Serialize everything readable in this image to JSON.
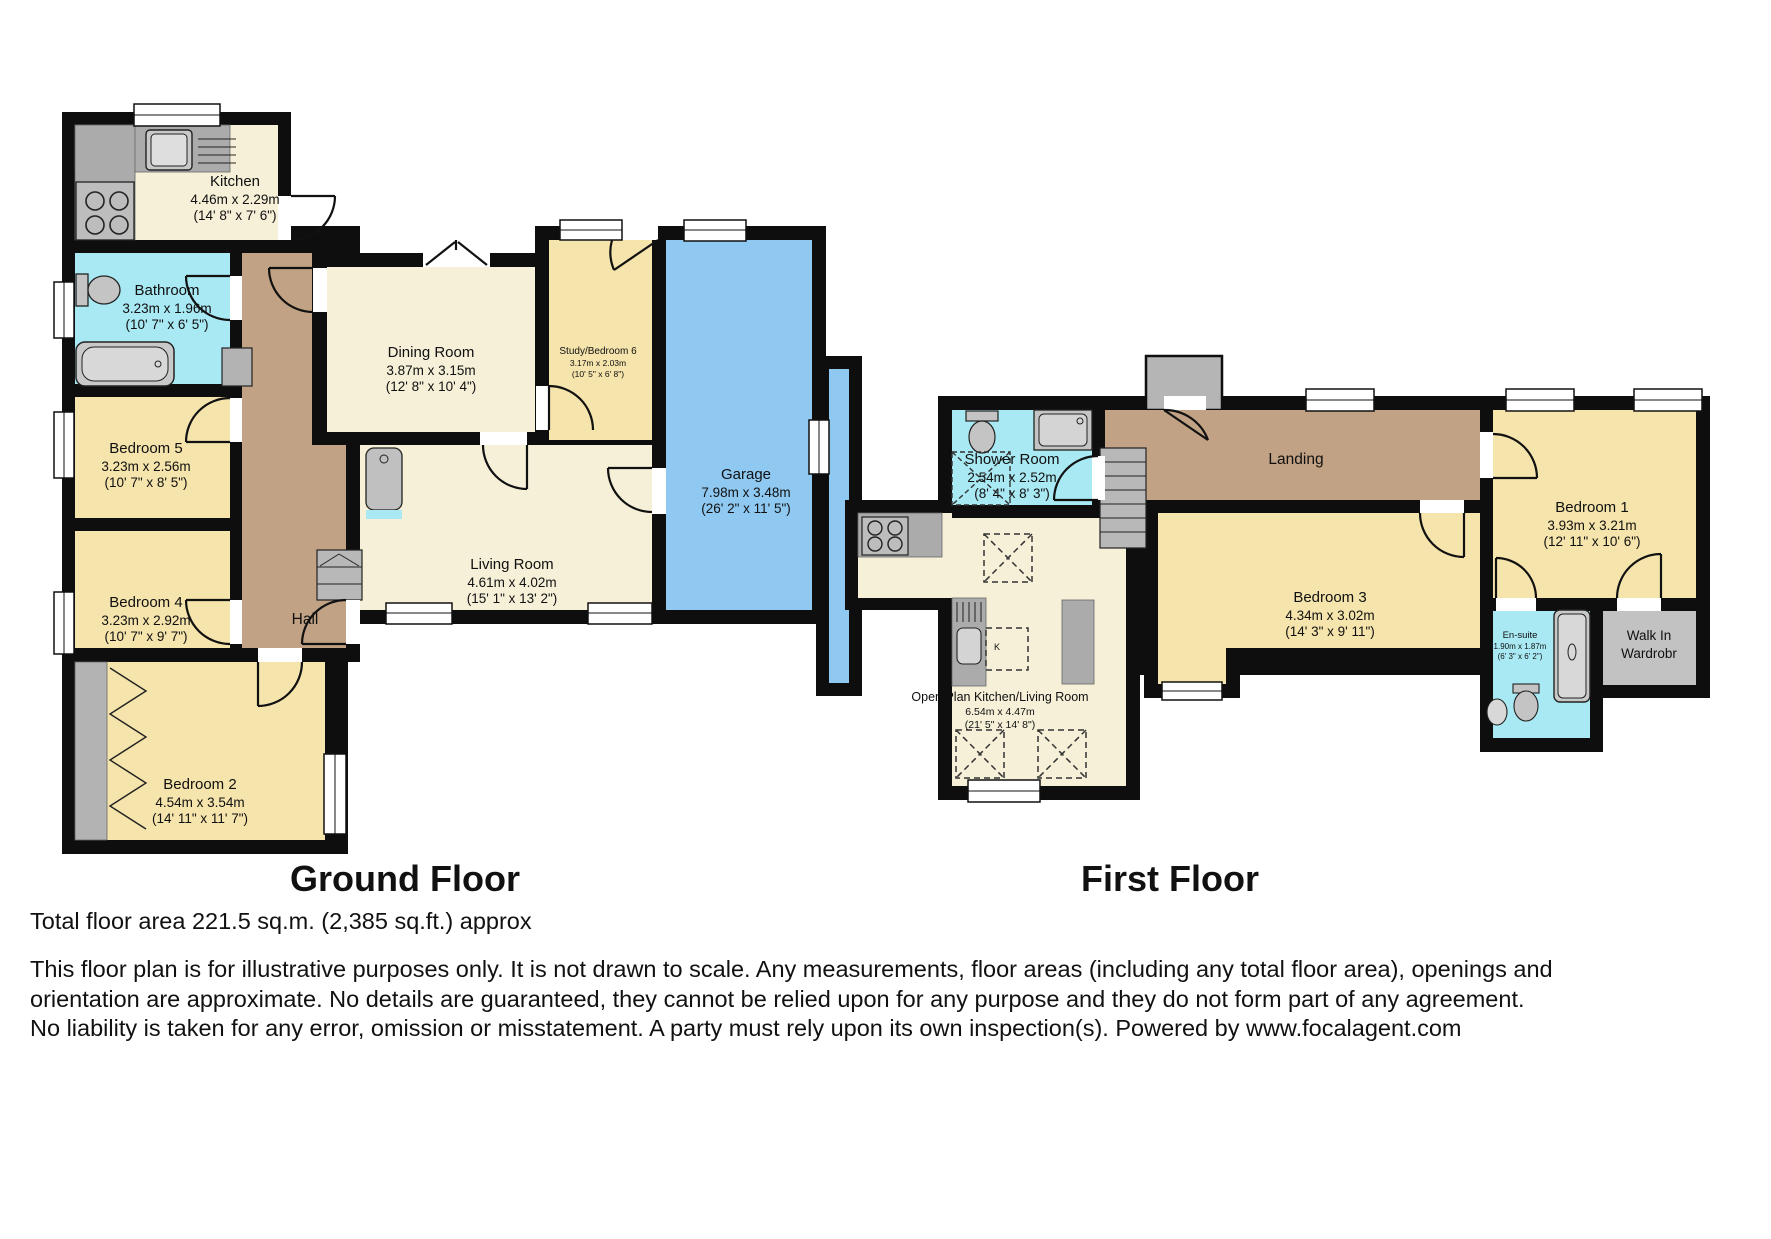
{
  "ground_floor": {
    "title": "Ground Floor",
    "rooms": {
      "kitchen": {
        "name": "Kitchen",
        "metric": "4.46m x 2.29m",
        "imperial": "(14' 8\" x 7' 6\")"
      },
      "bathroom": {
        "name": "Bathroom",
        "metric": "3.23m x 1.96m",
        "imperial": "(10' 7\" x 6' 5\")"
      },
      "dining": {
        "name": "Dining Room",
        "metric": "3.87m x 3.15m",
        "imperial": "(12' 8\" x 10' 4\")"
      },
      "study": {
        "name": "Study/Bedroom 6",
        "metric": "3.17m x 2.03m",
        "imperial": "(10' 5\" x 6' 8\")"
      },
      "garage": {
        "name": "Garage",
        "metric": "7.98m x 3.48m",
        "imperial": "(26' 2\" x 11' 5\")"
      },
      "bedroom5": {
        "name": "Bedroom 5",
        "metric": "3.23m x 2.56m",
        "imperial": "(10' 7\" x 8' 5\")"
      },
      "bedroom4": {
        "name": "Bedroom 4",
        "metric": "3.23m x 2.92m",
        "imperial": "(10' 7\" x 9' 7\")"
      },
      "living": {
        "name": "Living Room",
        "metric": "4.61m x 4.02m",
        "imperial": "(15' 1\" x 13' 2\")"
      },
      "hall": {
        "name": "Hall"
      },
      "bedroom2": {
        "name": "Bedroom 2",
        "metric": "4.54m x 3.54m",
        "imperial": "(14' 11\" x 11' 7\")"
      }
    }
  },
  "first_floor": {
    "title": "First Floor",
    "rooms": {
      "shower": {
        "name": "Shower Room",
        "metric": "2.54m x 2.52m",
        "imperial": "(8' 4\" x 8' 3\")"
      },
      "landing": {
        "name": "Landing"
      },
      "bedroom1": {
        "name": "Bedroom 1",
        "metric": "3.93m x 3.21m",
        "imperial": "(12' 11\" x 10' 6\")"
      },
      "bedroom3": {
        "name": "Bedroom 3",
        "metric": "4.34m x 3.02m",
        "imperial": "(14' 3\" x 9' 11\")"
      },
      "ensuite": {
        "name": "En-suite",
        "metric": "1.90m x 1.87m",
        "imperial": "(6' 3\" x 6' 2\")"
      },
      "walkin": {
        "line1": "Walk In",
        "line2": "Wardrobr"
      },
      "openplan": {
        "name": "Open Plan Kitchen/Living Room",
        "metric": "6.54m x 4.47m",
        "imperial": "(21' 5\" x 14' 8\")"
      },
      "kitchen_table_label": "K"
    }
  },
  "footer": {
    "total_area": "Total floor area 221.5 sq.m. (2,385 sq.ft.) approx",
    "disclaimer": "This floor plan is for illustrative purposes only. It is not drawn to scale. Any measurements, floor areas (including any total floor area), openings and orientation are approximate. No details are guaranteed, they cannot be relied upon for any purpose and they do not form part of any agreement. No liability is taken for any error, omission or misstatement. A party must rely upon its own inspection(s). Powered by www.focalagent.com"
  },
  "colors": {
    "room_cream": "#F6F0D8",
    "room_yellow": "#F5E4AC",
    "room_cyan": "#A9E9F3",
    "garage_blue": "#8FC9F1",
    "hall_brown": "#C1A284",
    "wall_black": "#0E0E0E",
    "fixture_gray": "#BEBEBE"
  }
}
